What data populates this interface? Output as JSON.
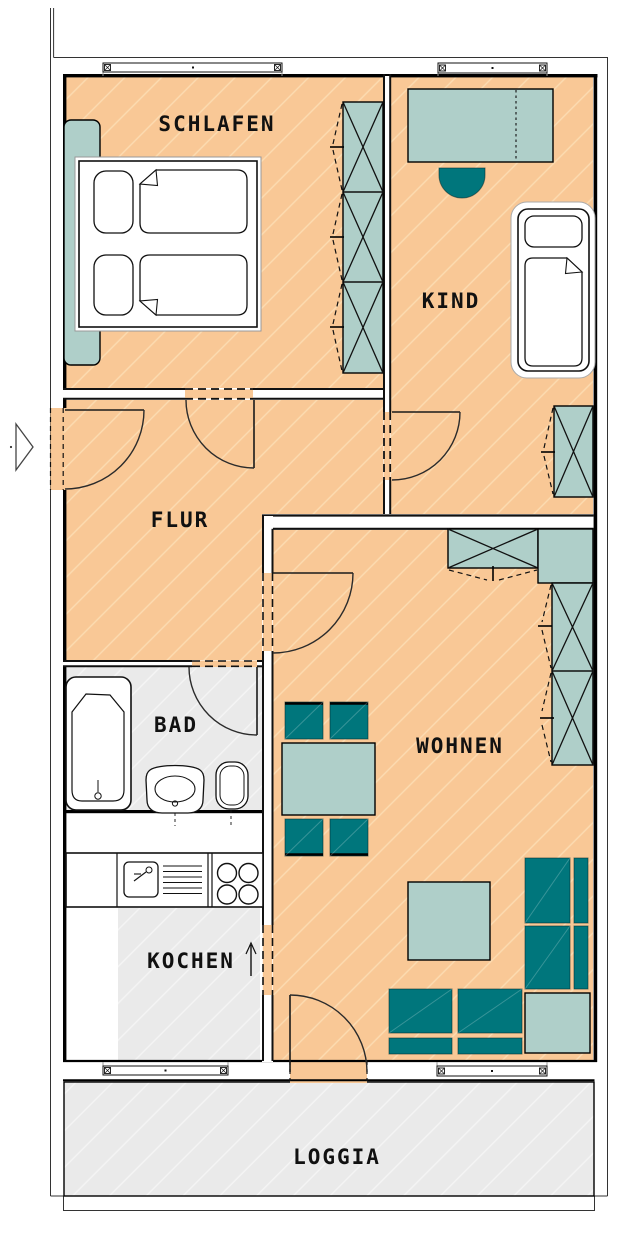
{
  "plan": {
    "rooms": {
      "schlafen": {
        "label": "SCHLAFEN",
        "furniture": [
          "double-bed",
          "side-cabinet",
          "wardrobe"
        ]
      },
      "kind": {
        "label": "KIND",
        "furniture": [
          "desk",
          "chair",
          "single-bed",
          "wardrobe"
        ]
      },
      "flur": {
        "label": "FLUR",
        "furniture": []
      },
      "bad": {
        "label": "BAD",
        "furniture": [
          "bathtub",
          "washbasin",
          "toilet"
        ]
      },
      "wohnen": {
        "label": "WOHNEN",
        "furniture": [
          "dining-table",
          "four-chairs",
          "wall-unit",
          "coffee-table",
          "corner-sofa",
          "side-table"
        ]
      },
      "kochen": {
        "label": "KOCHEN",
        "furniture": [
          "kitchen-counter",
          "sink",
          "drainer",
          "stove"
        ]
      },
      "loggia": {
        "label": "LOGGIA",
        "furniture": []
      }
    },
    "icons": {
      "entrance": "triangle-right-arrow",
      "kochen_direction": "arrow-up"
    },
    "colors": {
      "floor_living": "#F9C896",
      "floor_hard": "#EAEAEA",
      "furniture_light": "#AFCFC9",
      "furniture_dark": "#00767C",
      "walls": "#000000",
      "background": "#FFFFFF"
    }
  }
}
